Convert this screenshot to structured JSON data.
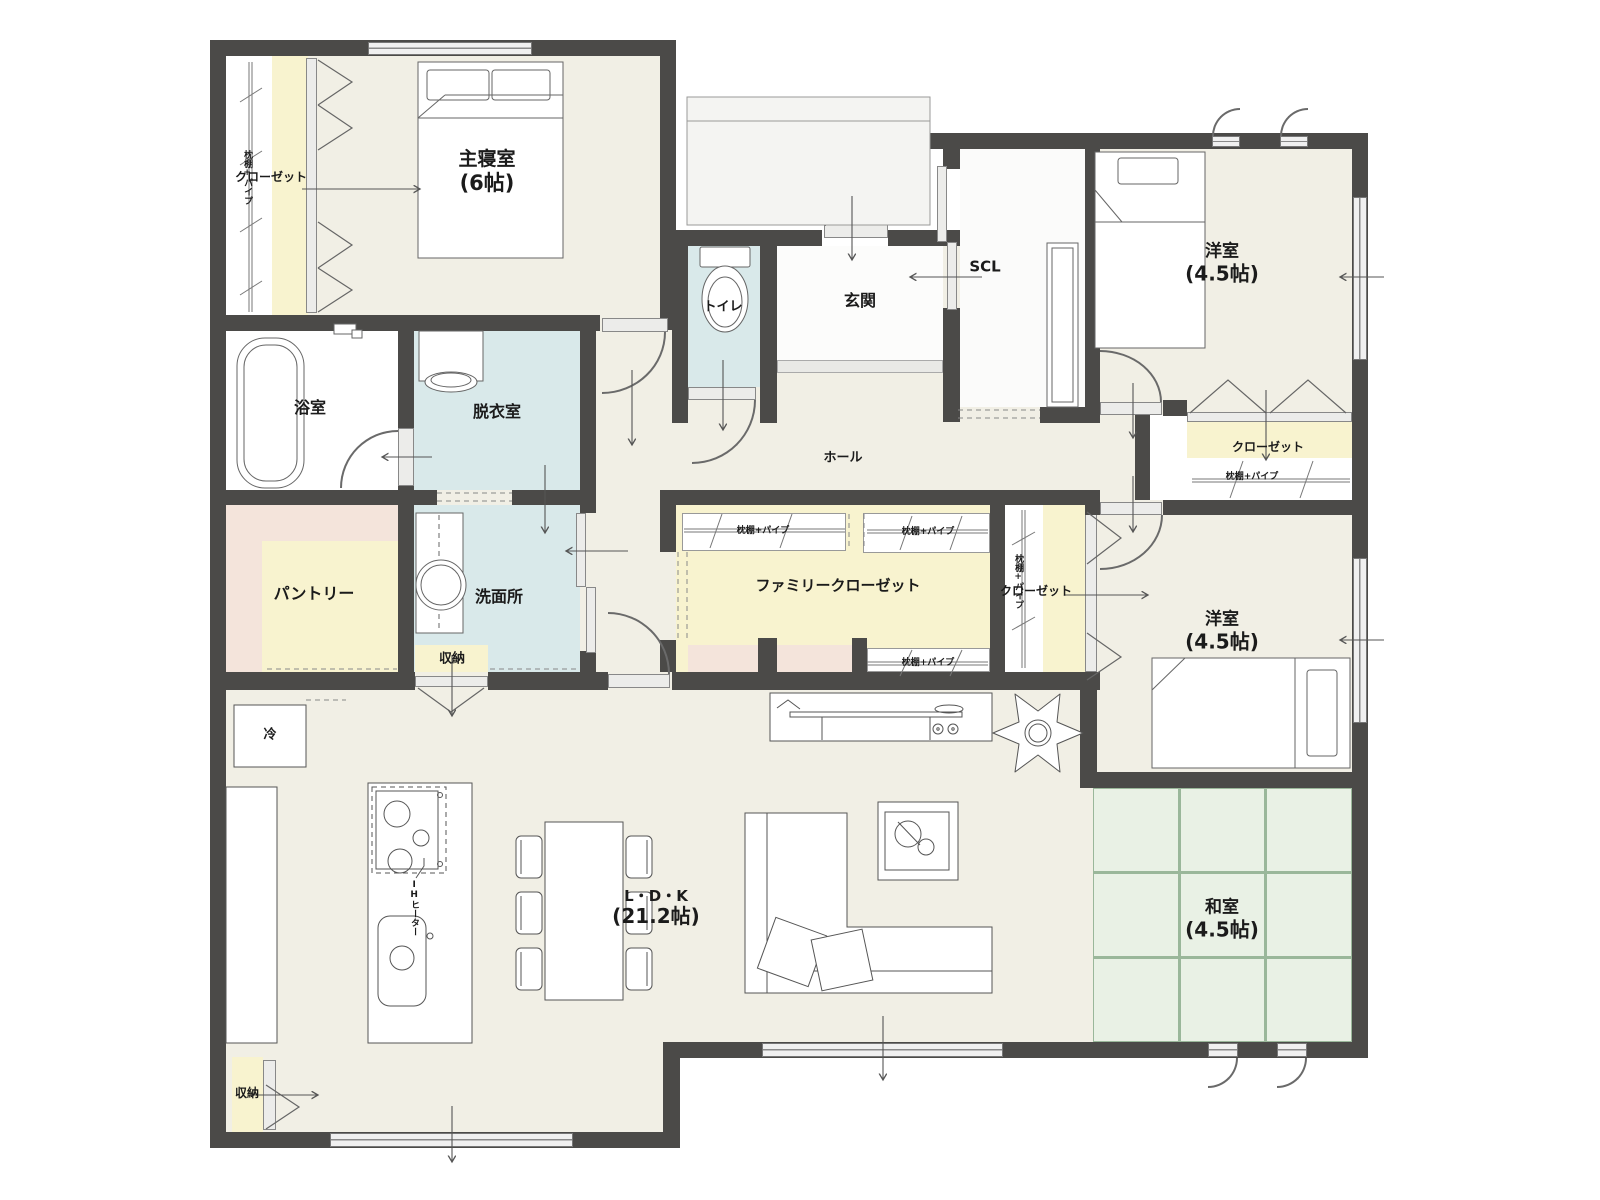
{
  "rooms": {
    "master_bedroom": {
      "name": "主寝室",
      "size": "(6帖)"
    },
    "bedroom_ne": {
      "name": "洋室",
      "size": "(4.5帖)"
    },
    "bedroom_se": {
      "name": "洋室",
      "size": "(4.5帖)"
    },
    "tatami_room": {
      "name": "和室",
      "size": "(4.5帖)"
    },
    "ldk": {
      "name": "L・D・K",
      "size": "(21.2帖)"
    },
    "bathroom": {
      "name": "浴室"
    },
    "dressing_room": {
      "name": "脱衣室"
    },
    "washroom": {
      "name": "洗面所"
    },
    "pantry": {
      "name": "パントリー"
    },
    "toilet": {
      "name": "トイレ"
    },
    "entrance": {
      "name": "玄関"
    },
    "shoe_closet": {
      "name": "SCL"
    },
    "hall": {
      "name": "ホール"
    },
    "family_closet": {
      "name": "ファミリークローゼット"
    },
    "closet_master": {
      "name": "クローゼット"
    },
    "closet_ne": {
      "name": "クローゼット"
    },
    "closet_mid": {
      "name": "クローゼット"
    },
    "storage_inner": {
      "name": "収納"
    },
    "storage_sw": {
      "name": "収納"
    }
  },
  "annotations": {
    "shelf_pipe": "枕棚+パイプ",
    "fridge": "冷",
    "ih_heater": "IHヒーター"
  },
  "colors": {
    "wall": "#4b4a48",
    "floor": "#f1efe5",
    "closet": "#f8f3cf",
    "water": "#d9e9ea",
    "pink": "#f4e4db",
    "tatami": "#e9f1e5",
    "tatami_line": "#9ab79a",
    "porch": "#f4f4f2",
    "window": "#f0f0f0"
  }
}
